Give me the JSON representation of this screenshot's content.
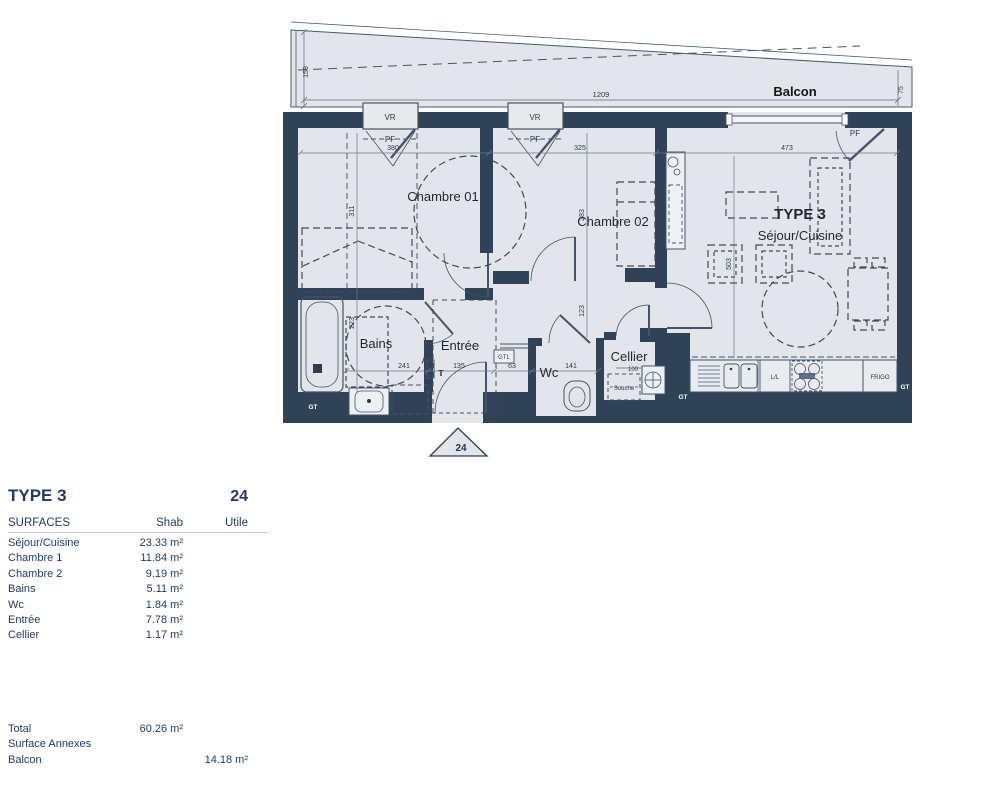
{
  "plan": {
    "balcon": "Balcon",
    "lot": "24",
    "rooms": {
      "ch1": "Chambre 01",
      "ch2": "Chambre 02",
      "type": "TYPE 3",
      "sejour": "Séjour/Cuisine",
      "bains": "Bains",
      "entree": "Entrée",
      "wc": "Wc",
      "cellier": "Cellier"
    },
    "windows": {
      "vr": "VR",
      "pf": "PF"
    },
    "dims": {
      "balcony_len": "1209",
      "balcony_left": "159",
      "balcony_right": "75",
      "ch1_w": "380",
      "ch2_w": "325",
      "sejour_w": "473",
      "ch1_d": "311",
      "ch2_d": "283",
      "bains_d": "223",
      "sejour_d": "503",
      "corridor_d": "123",
      "bains_w": "241",
      "entree_w": "135",
      "hall_w": "63",
      "wc_w": "141",
      "cellier_w": "100"
    },
    "labels": {
      "gt": "GT",
      "gtl": "GTL",
      "ll": "LL",
      "lv": "L/L",
      "frigo": "FRIGO",
      "souche": "Souche",
      "radiator": "T"
    },
    "colors": {
      "wall": "#304257",
      "floor": "#e2e5e9",
      "ink": "#2d3a50"
    }
  },
  "table": {
    "title": "TYPE 3",
    "lot": "24",
    "header": {
      "surfaces": "SURFACES",
      "shab": "Shab",
      "utile": "Utile"
    },
    "rows": [
      {
        "label": "Séjour/Cuisine",
        "shab": "23.33 m²"
      },
      {
        "label": "Chambre 1",
        "shab": "11.84 m²"
      },
      {
        "label": "Chambre 2",
        "shab": "9.19 m²"
      },
      {
        "label": "Bains",
        "shab": "5.11 m²"
      },
      {
        "label": "Wc",
        "shab": "1.84 m²"
      },
      {
        "label": "Entrée",
        "shab": "7.78 m²"
      },
      {
        "label": "Cellier",
        "shab": "1.17 m²"
      }
    ],
    "total": {
      "label": "Total",
      "shab": "60.26 m²"
    },
    "annex_title": "Surface Annexes",
    "annex": {
      "label": "Balcon",
      "utile": "14.18 m²"
    }
  }
}
